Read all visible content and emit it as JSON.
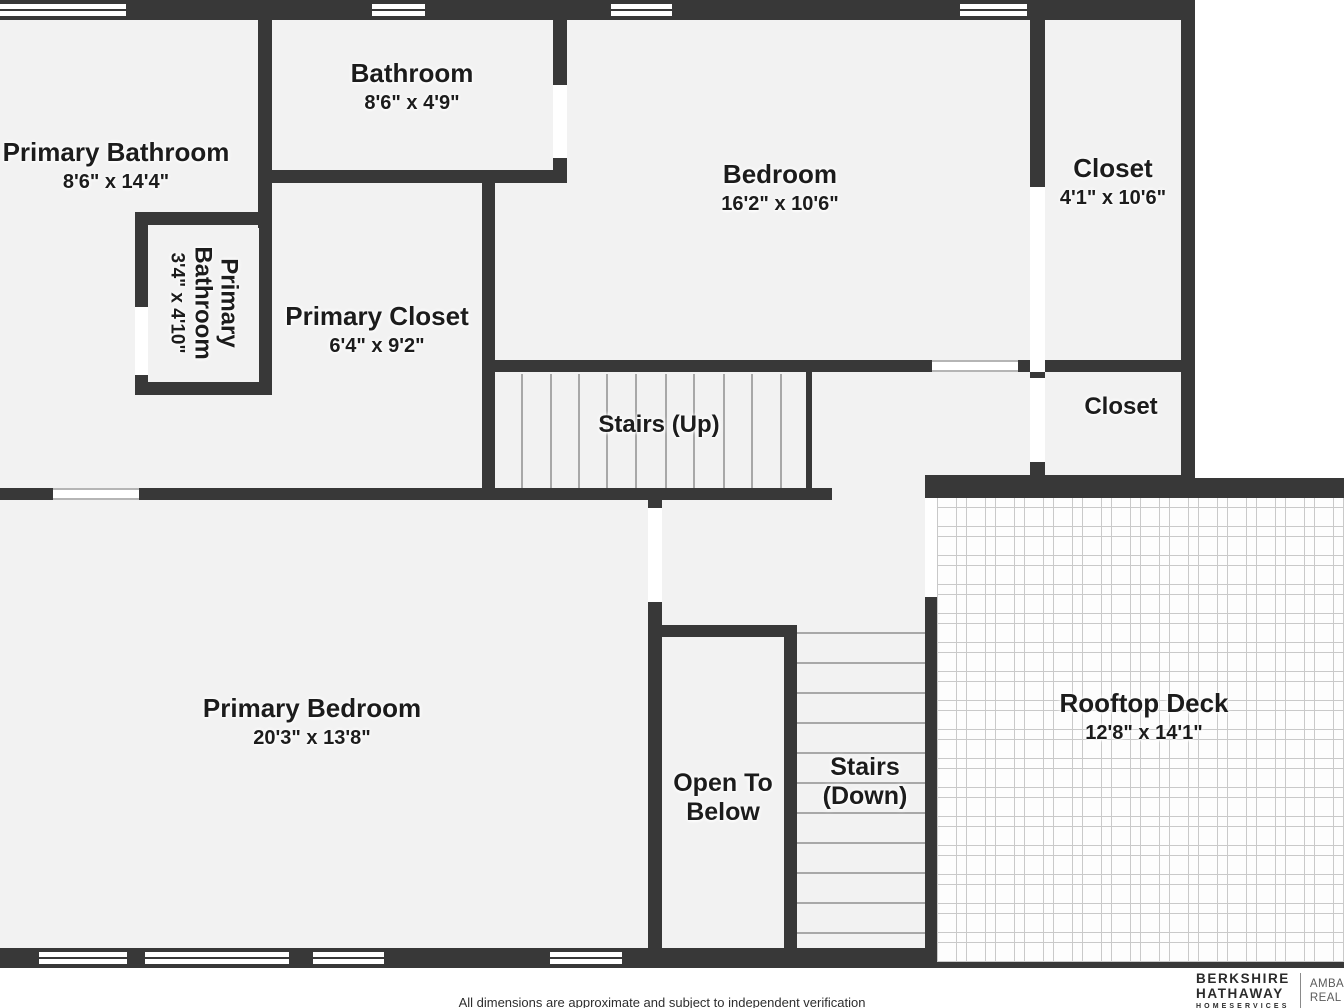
{
  "palette": {
    "wall": "#383838",
    "room_fill": "#f2f2f2",
    "deck_grid_line": "#c9c9c9",
    "stair_tread_line": "#a8a8a8",
    "label_text": "#1c1c1c"
  },
  "rooms": {
    "primary_bathroom": {
      "name": "Primary Bathroom",
      "dims": "8'6\" x 14'4\""
    },
    "bathroom": {
      "name": "Bathroom",
      "dims": "8'6\" x 4'9\""
    },
    "bedroom": {
      "name": "Bedroom",
      "dims": "16'2\" x 10'6\""
    },
    "closet_top": {
      "name": "Closet",
      "dims": "4'1\" x 10'6\""
    },
    "primary_bathroom_small": {
      "name": "Primary Bathroom",
      "dims": "3'4\" x 4'10\""
    },
    "primary_closet": {
      "name": "Primary Closet",
      "dims": "6'4\" x 9'2\""
    },
    "stairs_up": {
      "name": "Stairs (Up)"
    },
    "closet_mid": {
      "name": "Closet"
    },
    "rooftop_deck": {
      "name": "Rooftop Deck",
      "dims": "12'8\" x 14'1\""
    },
    "primary_bedroom": {
      "name": "Primary Bedroom",
      "dims": "20'3\" x 13'8\""
    },
    "open_to_below": {
      "name": "Open To Below"
    },
    "stairs_down": {
      "name": "Stairs (Down)"
    }
  },
  "footer": {
    "disclaimer": "All dimensions are approximate and subject to independent verification"
  },
  "brand": {
    "line1": "BERKSHIRE",
    "line2": "HATHAWAY",
    "line3": "HOMESERVICES",
    "partner_line1": "AMBASS",
    "partner_line2": "REAL ES"
  }
}
